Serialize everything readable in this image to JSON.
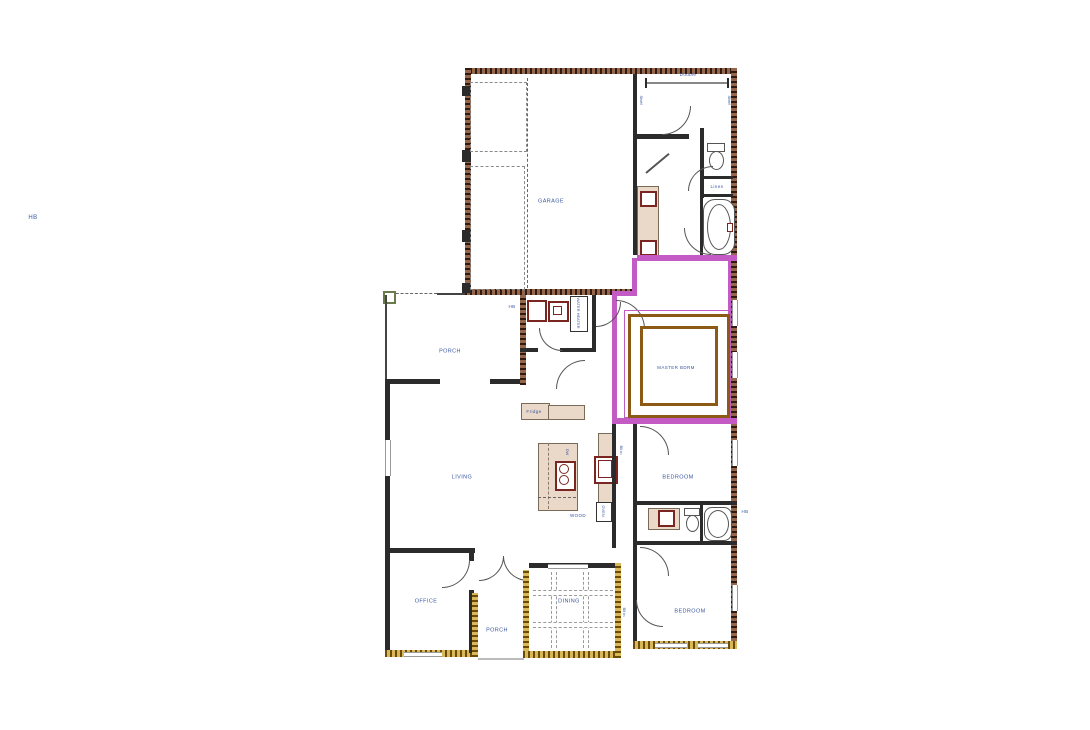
{
  "plan": {
    "rooms": {
      "garage": "GARAGE",
      "back_porch": "PORCH",
      "living": "LIVING",
      "office": "OFFICE",
      "entry_porch": "PORCH",
      "dining": "DINING",
      "master_bedroom": "MASTER BDRM",
      "bedroom_mid": "BEDROOM",
      "bedroom_rear": "BEDROOM"
    },
    "annotations": {
      "hose_bib_far_left": "HB",
      "hose_bib_back_porch": "HB",
      "hose_bib_right": "HB",
      "double_closet": "Double",
      "linen_closet": "Linen",
      "fridge": "Fridge",
      "wood_floor": "WOOD",
      "oven": "OVEN",
      "dishwasher": "DW",
      "water_heater": "WATER HEATER",
      "built_in_mid": "Blt in",
      "built_in_rear": "Blt in",
      "closet_shelf_left": "Shelf",
      "closet_shelf_right": "Shelf"
    },
    "colors": {
      "label_text": "#3a57a0",
      "exterior_wall": "#96664a",
      "master_suite_wall": "#c45ac4",
      "accent_wall": "#d9b85a",
      "interior_wall": "#2b2b2b",
      "fixture_accent": "#7a2520",
      "tray_ceiling": "#8a5a16"
    }
  }
}
